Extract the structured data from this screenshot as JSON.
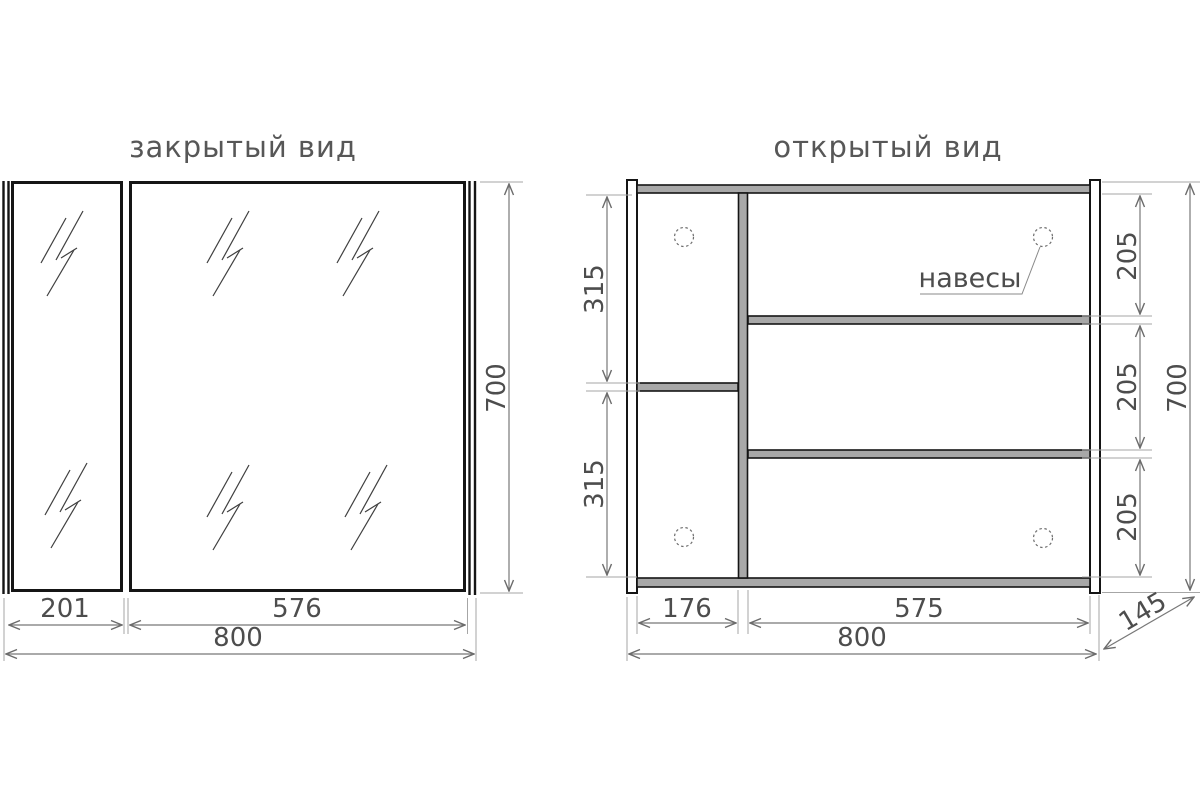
{
  "drawing": {
    "closed_view": {
      "title": "закрытый вид",
      "dim_left_door_width": "201",
      "dim_main_door_width": "576",
      "dim_total_width": "800",
      "dim_height": "700"
    },
    "open_view": {
      "title": "открытый вид",
      "hinge_callout": "навесы",
      "dim_left_section_top": "315",
      "dim_left_section_bottom": "315",
      "dim_shelf_gap_1": "205",
      "dim_shelf_gap_2": "205",
      "dim_shelf_gap_3": "205",
      "dim_height": "700",
      "dim_left_section_width": "176",
      "dim_right_section_width": "575",
      "dim_total_width": "800",
      "dim_depth": "145"
    },
    "colors": {
      "structure_line": "#151515",
      "shelf_fill": "#a8a8a8",
      "dimension_line": "#787878",
      "extension_line": "#a6a6a6",
      "text": "#4d4d4d",
      "title": "#575757",
      "background": "#ffffff"
    }
  }
}
